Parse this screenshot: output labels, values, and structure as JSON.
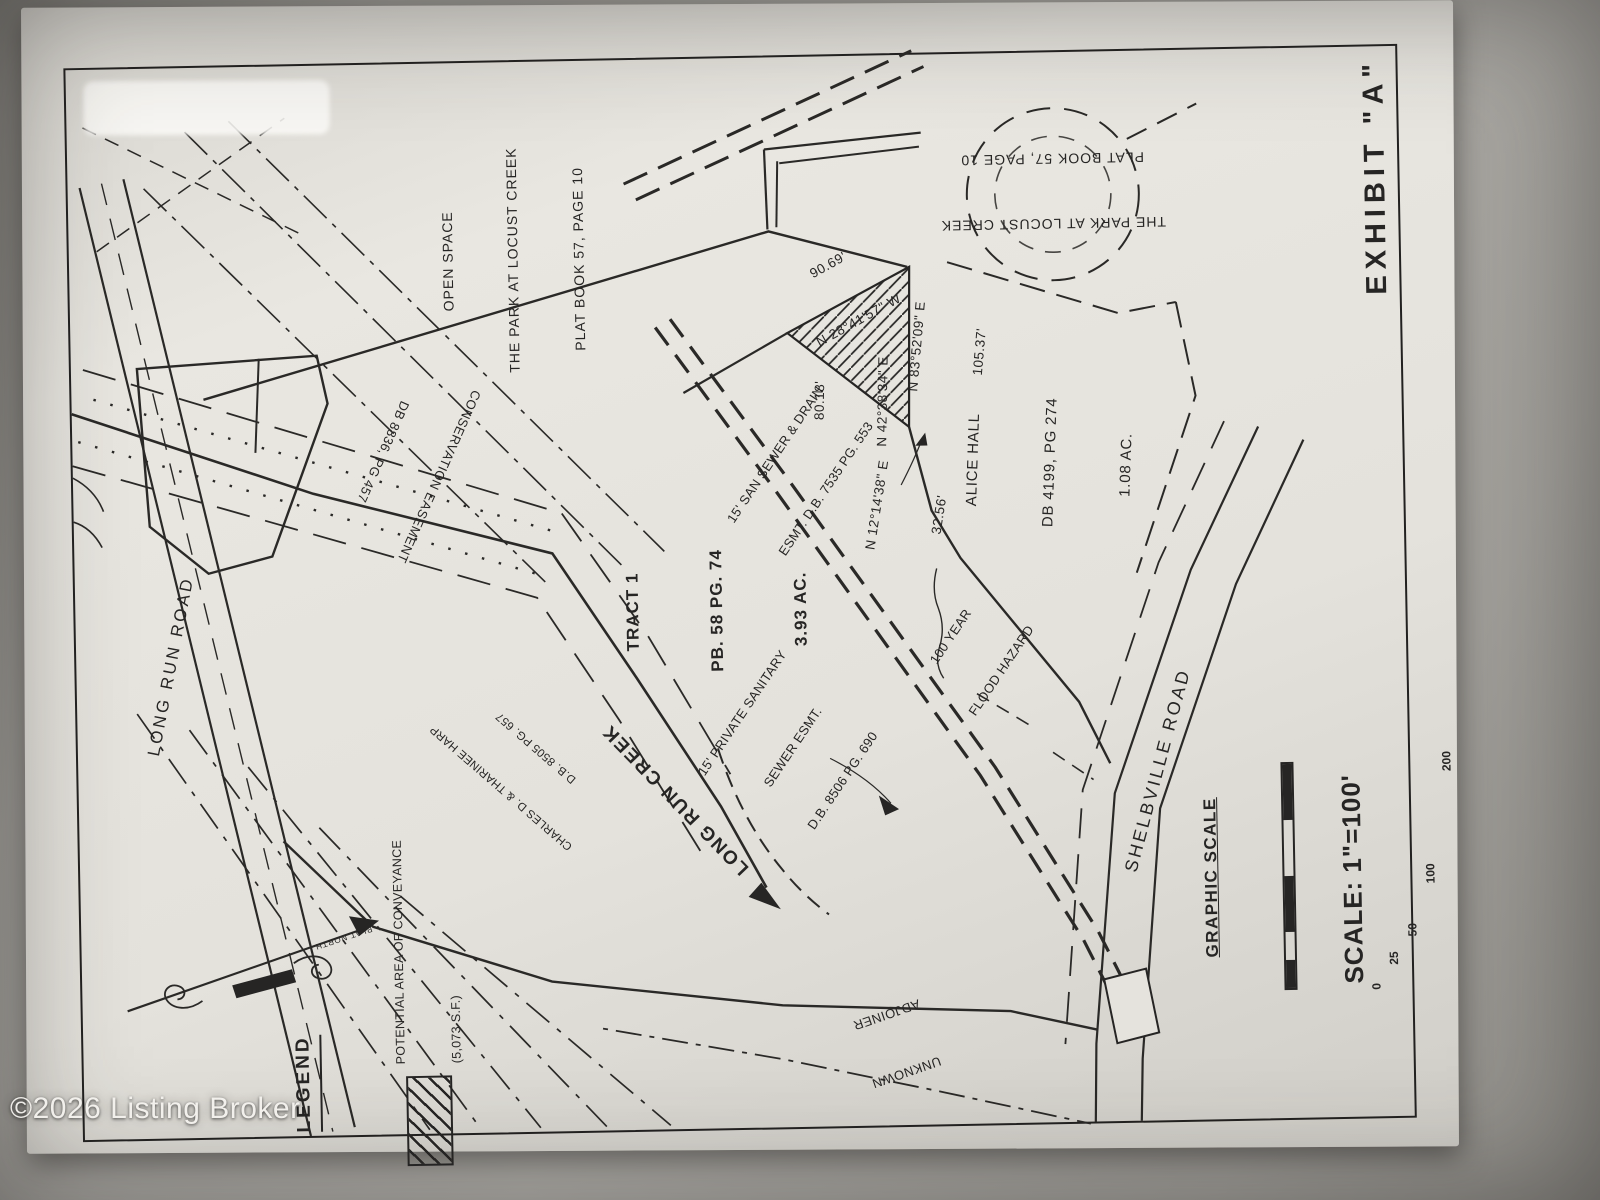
{
  "watermark": "©2026 Listing Broker",
  "exhibit_label": "EXHIBIT \"A\"",
  "north_arrow": {
    "label": "PLAT NORTH"
  },
  "legend": {
    "title": "LEGEND",
    "item_line1": "POTENTIAL AREA OF CONVEYANCE",
    "item_line2": "(5,073 S.F.)"
  },
  "scale": {
    "title": "GRAPHIC SCALE",
    "ticks": [
      "0",
      "25",
      "50",
      "100",
      "200"
    ],
    "ratio": "SCALE: 1\"=100'"
  },
  "roads": {
    "long_run_road": "LONG RUN ROAD",
    "shelbville_road": "SHELBVILLE ROAD"
  },
  "creek_label": "LONG RUN CREEK",
  "parcels": {
    "tract1": {
      "lines": [
        "TRACT 1",
        "PB. 58 PG. 74",
        "3.93 AC."
      ]
    },
    "alice_hall": {
      "lines": [
        "ALICE HALL",
        "DB 4199, PG 274",
        "1.08 AC."
      ]
    },
    "open_space": {
      "lines": [
        "OPEN SPACE",
        "THE PARK AT LOCUST CREEK",
        "PLAT BOOK 57, PAGE 10"
      ]
    },
    "park_at_locust_creek": {
      "lines": [
        "THE PARK AT LOCUST CREEK",
        "PLAT BOOK 57, PAGE 10"
      ]
    },
    "harp": {
      "lines": [
        "CHARLES D. & THARINEE HARP",
        "D.B. 8505 PG. 657"
      ]
    },
    "unknown_adjoiner": {
      "lines": [
        "UNKNOWN",
        "ADJOINER"
      ]
    }
  },
  "easements": {
    "conservation": {
      "lines": [
        "CONSERVATION EASEMENT",
        "DB 8836, PG 457"
      ]
    },
    "san_sewer": {
      "lines": [
        "15' SAN SEWER & DRAIN",
        "ESMT. D.B. 7535 PG. 553"
      ]
    },
    "private_sewer": {
      "lines": [
        "15' PRIVATE SANITARY",
        "SEWER ESMT.",
        "D.B. 8506 PG. 690"
      ]
    },
    "flood_hazard": {
      "lines": [
        "100 YEAR",
        "FLOOD HAZARD"
      ]
    }
  },
  "bearings": {
    "creek_line": {
      "lines": [
        "90.69'",
        "N 28°41'57\" W"
      ]
    },
    "east_line": {
      "lines": [
        "N 83°52'09\" E",
        "105.37'"
      ]
    },
    "southwest_line": {
      "lines": [
        "80.18'",
        "N 42°38'34\" E"
      ]
    },
    "short_line": {
      "lines": [
        "N 12°14'38\" E",
        "32.56'"
      ]
    }
  },
  "colors": {
    "ink": "#262524",
    "paper": "#e7e5df",
    "background": "#a3a19c"
  }
}
